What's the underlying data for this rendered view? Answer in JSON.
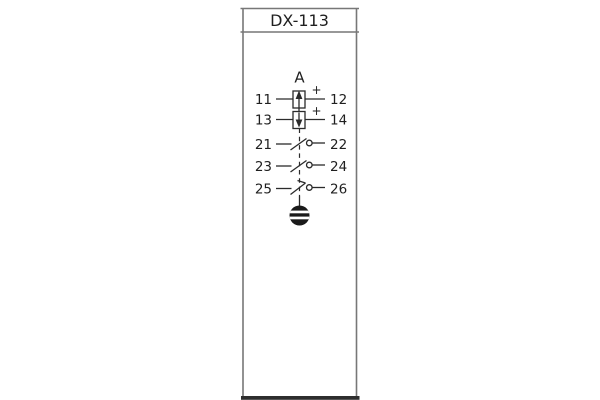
{
  "relay": {
    "model": "DX-113",
    "element_label": "A",
    "rows": [
      {
        "left": "11",
        "right": "12",
        "polarity": "+",
        "symbol": "measuring-element-arrow-up"
      },
      {
        "left": "13",
        "right": "14",
        "polarity": "+",
        "symbol": "measuring-element-arrow-down"
      },
      {
        "left": "21",
        "right": "22",
        "symbol": "normally-open-contact"
      },
      {
        "left": "23",
        "right": "24",
        "symbol": "normally-open-contact"
      },
      {
        "left": "25",
        "right": "26",
        "symbol": "normally-open-contact-hooked"
      }
    ],
    "indicator": "operation-target-indicator"
  },
  "colors": {
    "background": "#ffffff",
    "frame": "#777777",
    "base_bar": "#2e2e2e",
    "symbol_lines": "#2b2b2b",
    "text": "#1f1f1f"
  }
}
